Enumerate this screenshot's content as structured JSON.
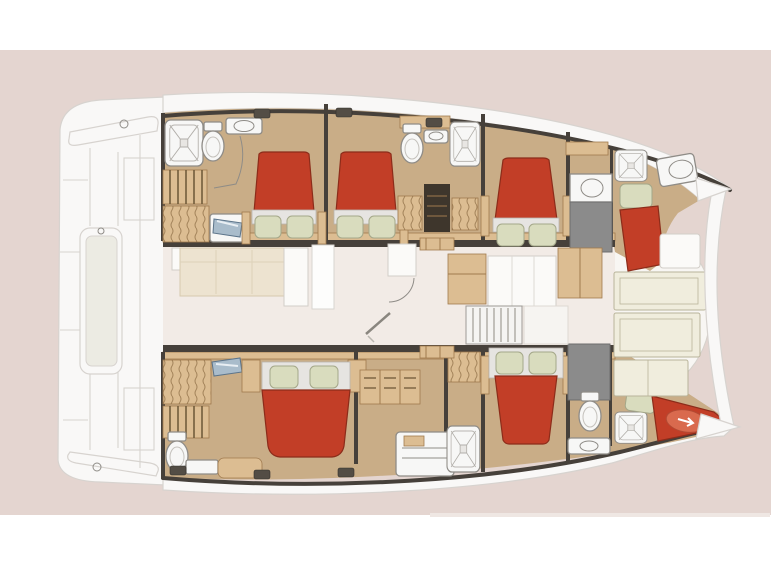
{
  "meta": {
    "diagram_type": "catamaran-interior-floor-plan",
    "orientation": "bow-right",
    "hulls": 2
  },
  "inventory": {
    "double_beds": 5,
    "forepeak_single_berths": 2,
    "shower_stalls": 5,
    "toilets": 4,
    "washbasins": 5,
    "hull_staircases": 4,
    "saloon_sofa": 1,
    "galley_blocks": 3,
    "wardrobes": 6,
    "deck_hatches": 6
  },
  "palette": {
    "background_pink": "#e4d5d0",
    "band_white": "#ffffff",
    "boat_white": "#f9f8f7",
    "boat_line": "#d7d3cf",
    "platform_pale": "#ecebe3",
    "wall_dark": "#46403a",
    "cabin_floor": "#c9ad87",
    "wood": "#dcbd92",
    "wood_dark": "#a07a4e",
    "bed_red": "#c23e27",
    "bed_red_dark": "#8c2c1a",
    "bed_red_light": "#d96a4e",
    "sheet_white": "#e6e4e1",
    "pillow_green": "#d9dcbe",
    "fixture_white": "#f7f7f6",
    "fixture_line": "#8f8c87",
    "mirror_blue": "#a9bccb",
    "tech_gray": "#8b8b8b",
    "saloon_floor": "#f2ebe6",
    "sofa_beige": "#ede3d0",
    "cockpit_cream": "#f0eddd",
    "cockpit_line": "#b9b49a",
    "hatch_dark": "#534d45",
    "steps_white": "#f5f4f2"
  }
}
